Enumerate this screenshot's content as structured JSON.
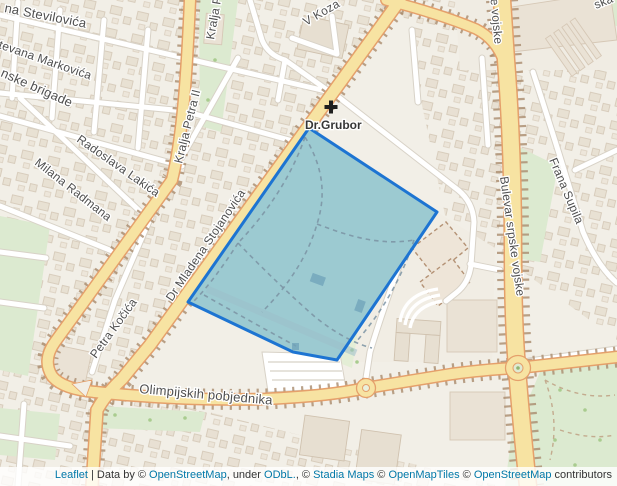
{
  "map": {
    "streets": {
      "stevilovica": "na Stevilovića",
      "markovica": "tevana Markovića",
      "brigade": "nske brigade",
      "lakica": "Radoslava Lakića",
      "radmana": "Milana Radmana",
      "kralja": "Kralja Petra II",
      "stojanovica": "Dr Mladena Stojanovića",
      "kocica": "Petra Kočića",
      "olimpijskih": "Olimpijskih pobjednika",
      "bulevar": "Bulevar srpske vojske",
      "frana": "Frana Supila",
      "vkoza": "V Koza",
      "ska": "ska"
    },
    "poi": {
      "grubor": "Dr.Grubor"
    },
    "colors": {
      "selection_stroke": "#1d74d2",
      "selection_fill": "#4aa3bd",
      "road_major_fill": "#f7e3a2",
      "land": "#f2efe7",
      "green": "#dcead0",
      "link_blue": "#0078a8"
    }
  },
  "attribution": {
    "leaflet": "Leaflet",
    "sep1": " | Data by © ",
    "osm1": "OpenStreetMap",
    "sep2": ", under ",
    "odbl": "ODbL.",
    "sep3": ", © ",
    "stadia": "Stadia Maps",
    "sep4": " © ",
    "omt": "OpenMapTiles",
    "sep5": " © ",
    "osm2": "OpenStreetMap",
    "sep6": " contributors"
  }
}
